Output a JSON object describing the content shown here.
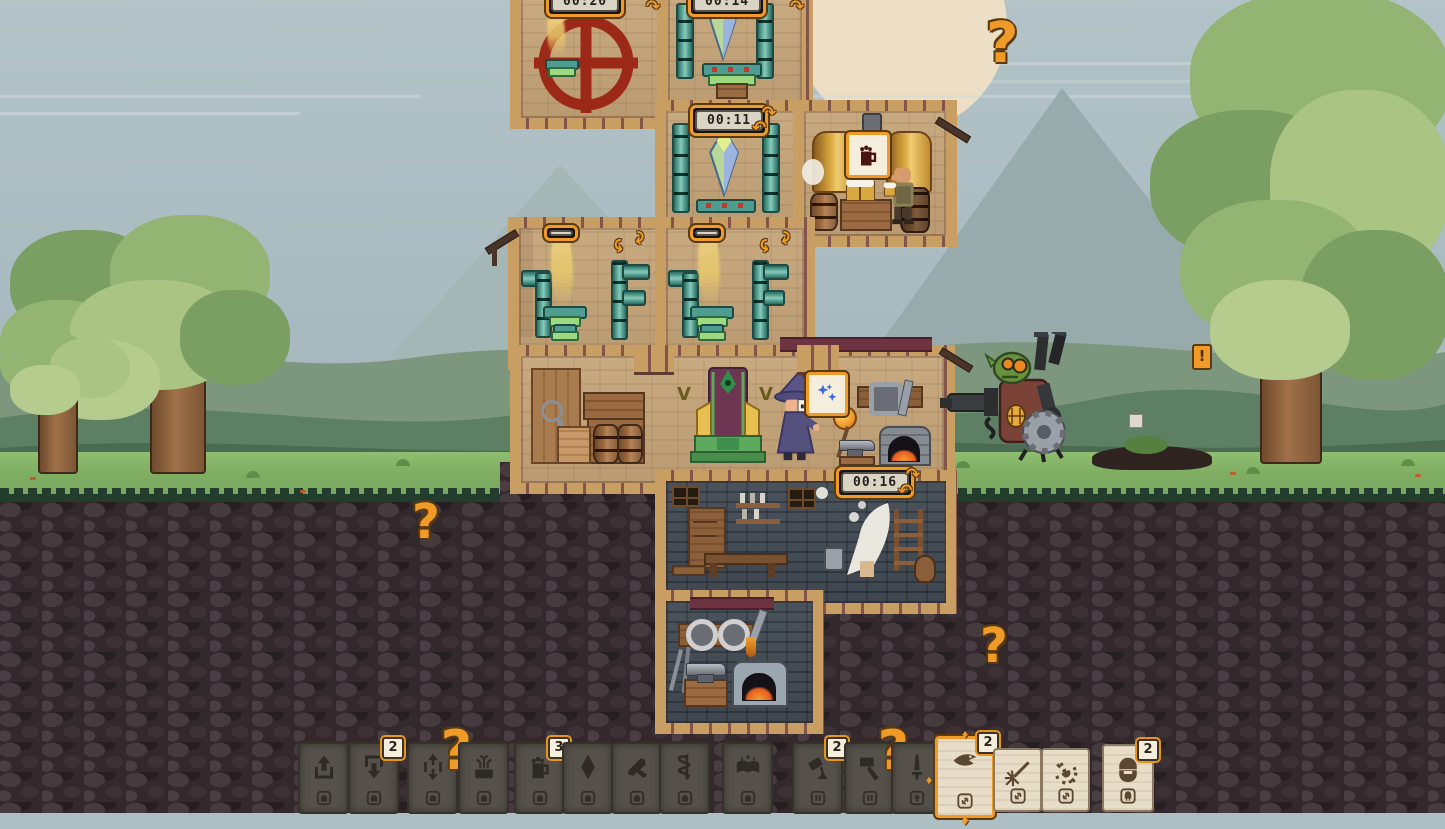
{
  "ui": {
    "timers": {
      "wheel_room": "00:20",
      "crystal_room_top": "00:14",
      "crystal_room": "00:11",
      "vent_room_left": "03:44",
      "vent_room_right": "06:22",
      "cellar_room": "00:16"
    },
    "hints": {
      "question_mark": "?",
      "alert_mark": "!"
    },
    "signs": {
      "brewery_sign_icon": "beer-mug",
      "anvil_sign_icon": "sparks"
    },
    "cards": [
      {
        "icon": "arrow-up",
        "slot_icon": "house-lamp",
        "badge": null,
        "style": "dark",
        "x": 298
      },
      {
        "icon": "arrow-down",
        "slot_icon": "house-lamp",
        "badge": "2",
        "style": "dark",
        "x": 348
      },
      {
        "icon": "arrow-updown",
        "slot_icon": "house-lamp",
        "badge": null,
        "style": "dark",
        "x": 407,
        "hint": "?"
      },
      {
        "icon": "plant-crate",
        "slot_icon": "house-lamp",
        "badge": null,
        "style": "dark",
        "x": 458
      },
      {
        "icon": "beer-mug",
        "slot_icon": "house-lamp",
        "badge": "3",
        "style": "dark",
        "x": 514
      },
      {
        "icon": "gem",
        "slot_icon": "house-lamp",
        "badge": null,
        "style": "dark",
        "x": 562
      },
      {
        "icon": "crossbow",
        "slot_icon": "house-lamp",
        "badge": null,
        "style": "dark",
        "x": 611
      },
      {
        "icon": "snake-staff",
        "slot_icon": "house-lamp",
        "badge": null,
        "style": "dark",
        "x": 659
      },
      {
        "icon": "magic-book",
        "slot_icon": "house-lamp",
        "badge": null,
        "style": "dark",
        "x": 722
      },
      {
        "icon": "pour-bucket",
        "slot_icon": "slot-bars",
        "badge": "2",
        "style": "dark",
        "x": 792
      },
      {
        "icon": "hammer",
        "slot_icon": "slot-bars",
        "badge": null,
        "style": "dark",
        "x": 844,
        "hint": "?"
      },
      {
        "icon": "sword",
        "slot_icon": "upgrade-arrow",
        "badge": null,
        "style": "dark",
        "x": 891
      },
      {
        "icon": "eagle",
        "slot_icon": "swap-arrows",
        "badge": "2",
        "style": "light",
        "highlighted": true,
        "x": 935,
        "y": 736,
        "w": 54,
        "h": 76
      },
      {
        "icon": "sword-spark",
        "slot_icon": "swap-arrows",
        "badge": null,
        "style": "light",
        "x": 993,
        "y": 748,
        "w": 45,
        "h": 60
      },
      {
        "icon": "burst",
        "slot_icon": "swap-arrows",
        "badge": null,
        "style": "light",
        "x": 1041,
        "y": 748,
        "w": 45,
        "h": 60
      },
      {
        "icon": "dwarf-head",
        "slot_icon": "helmet",
        "badge": "2",
        "style": "light",
        "x": 1102,
        "y": 744,
        "w": 48,
        "h": 64
      }
    ],
    "colors": {
      "accent_orange": "#f09a28",
      "outline_dark": "#5a3a10",
      "timer_face": "#d9d4c4",
      "card_dark": "#55514a",
      "card_light": "#e8ddc8",
      "wall_light": "#c9aa80",
      "wall_dark": "#4a535c",
      "pipe_teal": "#4f9d91",
      "wheel_red": "#9c2818"
    }
  }
}
